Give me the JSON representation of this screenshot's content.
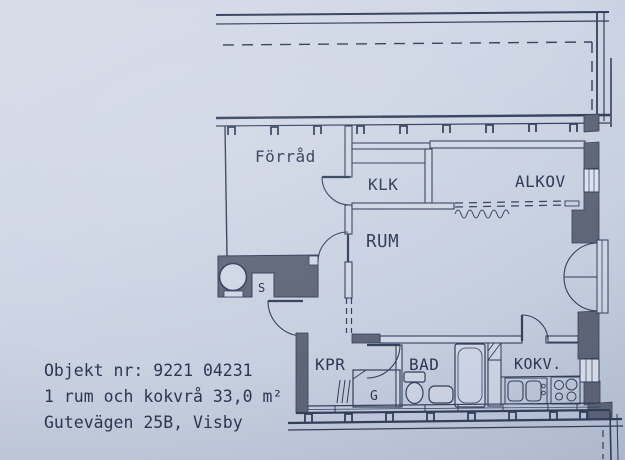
{
  "colors": {
    "paper": "#cfd6e5",
    "ink": "#33405c",
    "wall_fill": "#5f6678",
    "glass": "#dde3ee"
  },
  "plan": {
    "rooms": {
      "forrad": {
        "label": "Förråd"
      },
      "klk": {
        "label": "KLK"
      },
      "alkov": {
        "label": "ALKOV"
      },
      "rum": {
        "label": "RUM"
      },
      "kpr": {
        "label": "KPR"
      },
      "bad": {
        "label": "BAD"
      },
      "kokv": {
        "label": "KOKV."
      }
    },
    "annotations": {
      "wardrobe": "G",
      "shaft": "S"
    }
  },
  "footer": {
    "object_line": "Objekt nr: 9221 04231",
    "size_line": "1 rum och kokvrå 33,0 m²",
    "address_line": "Gutevägen 25B, Visby"
  }
}
